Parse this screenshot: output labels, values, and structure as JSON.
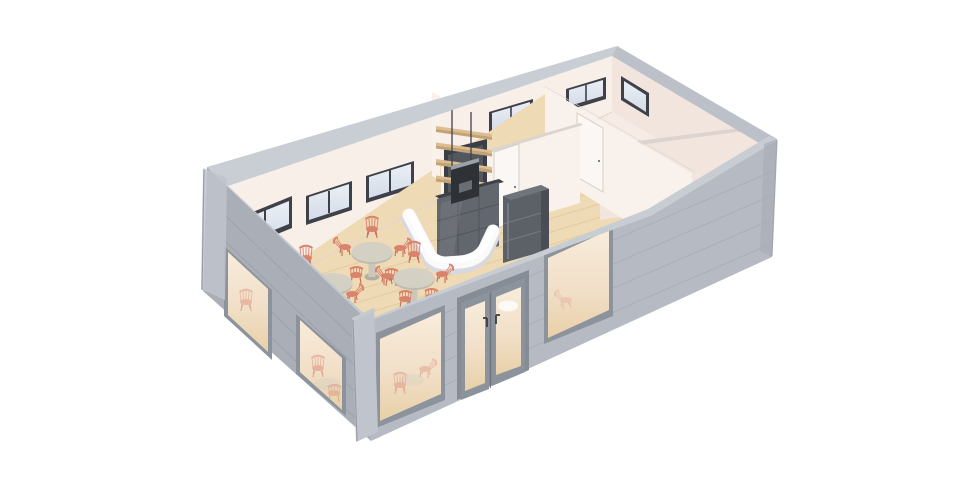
{
  "scene": {
    "description": "Isometric cutaway 3D render of a small cafe building (roof removed, walls cut at uniform height)",
    "view": "bird's-eye isometric from the south-west",
    "background": "#ffffff"
  },
  "building": {
    "shell": {
      "finish": "light gray horizontal siding",
      "left_wall": {
        "storefront_windows": 2
      },
      "front_wall": {
        "storefront_windows": 2,
        "entrance": "double glass door with dark lever handles"
      },
      "back_wall_windows": 5,
      "right_wall_windows": 1
    },
    "rooms": [
      {
        "id": "cafe",
        "name": "cafe seating area",
        "floor": "light wood planks",
        "tables": 3,
        "chairs": 13,
        "chair_style": "coral spindle-back bistro chair",
        "table_style": "round pedestal table, sage-gray top"
      },
      {
        "id": "service",
        "name": "service / barista zone",
        "floor": "light wood planks",
        "features": [
          "white curved service counter",
          "dark back-counter cabinet",
          "espresso machine",
          "4 wooden wall shelves on rails",
          "dark gray refrigerator",
          "white service door"
        ]
      },
      {
        "id": "back-room-1",
        "name": "back room behind counter",
        "floor": "warm white",
        "door": "white single door"
      },
      {
        "id": "back-room-2",
        "name": "large rear room",
        "floor": "warm white",
        "door": "white single door",
        "windows": 3
      },
      {
        "id": "back-room-3",
        "name": "front-right room",
        "floor": "warm white",
        "door": "white single door"
      }
    ]
  },
  "colors": {
    "bg": "#ffffff",
    "wall_interior": "#f8efe9",
    "wall_interior_shaded": "#f2e5de",
    "partition_lit": "#f9f1eb",
    "partition_shaded": "#f1e5de",
    "partition_cap": "#dcd5cf",
    "floor_wood": "#eedab5",
    "floor_plank_line": "#e0c79e",
    "floor_back_rooms": "#f6ece5",
    "floor_shadow": "#e5d6ce",
    "window_frame_dark": "#3e4147",
    "glass_cool_1": "#eaeff6",
    "glass_cool_2": "#d5dce8",
    "glass_warm_1": "#f8ecdb",
    "glass_warm_2": "#f1dfc8",
    "glass_warm_3": "#e8d0a8",
    "storefront_frame": "#8d939c",
    "door_frame_gray": "#868c95",
    "exterior_side": "#a9aeb7",
    "exterior_front": "#b6bac2",
    "siding_line_side": "#9ca2ab",
    "siding_line_front": "#a9aeb6",
    "cap_side": "#c5c9d0",
    "cap_front": "#c8ccd3",
    "cap_back": "#c9cdd4",
    "cap_right": "#bcc0c8",
    "corner_post": "#c0c4cc",
    "corner_post_dark": "#989ea8",
    "counter_shadow": "#d8d8de",
    "counter_face": "#fafafb",
    "counter_top": "#ffffff",
    "cabinet_top": "#3e4147",
    "cabinet_face": "#62666d",
    "cabinet_seam": "#50545c",
    "backsplash": "#3b3e44",
    "backsplash_inner": "#53575e",
    "machine_body": "#2e3136",
    "machine_steel": "#9ba1a9",
    "fridge_front": "#5c6067",
    "fridge_top": "#70747b",
    "fridge_side": "#4a4d54",
    "fridge_seam": "#74787f",
    "fridge_handle": "#878b92",
    "shelf_wood": "#dcbd90",
    "shelf_edge": "#c3a277",
    "shelf_rod": "#3f4248",
    "door_white": "#faf7f4",
    "door_white_frame": "#d5cdc6",
    "door_handle": "#6f7379",
    "entry_handle": "#3a3d42",
    "entry_gap": "#70757e",
    "chair_coral": "#d9826c",
    "chair_coral_dark": "#c76e59",
    "table_top": "#d4d0c3",
    "table_rim": "#bfbbae",
    "table_pedestal": "#cbc7bc",
    "table_base": "#b2aea3"
  }
}
